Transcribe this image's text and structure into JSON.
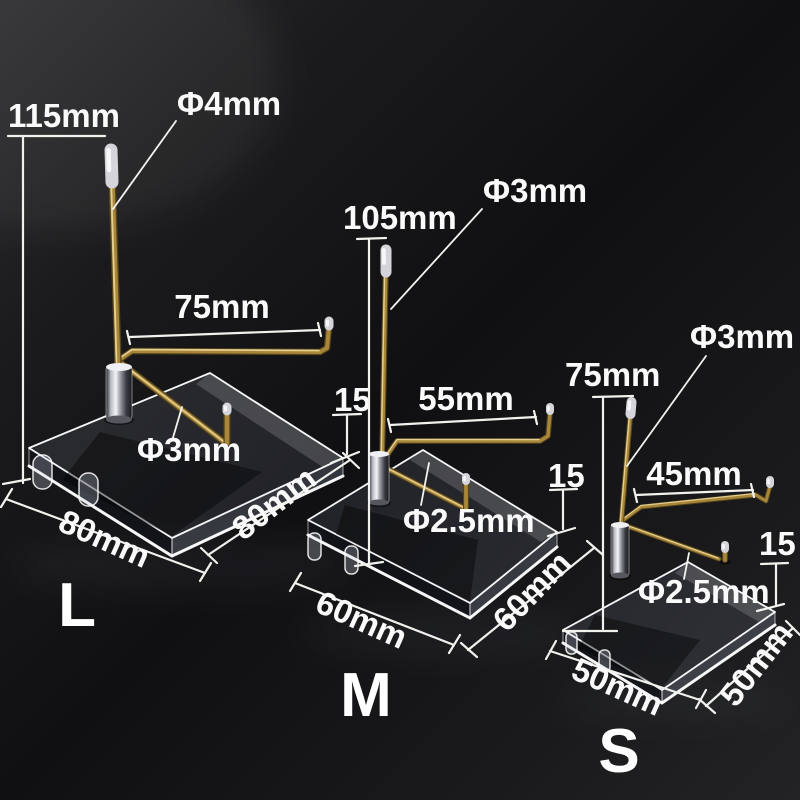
{
  "product": {
    "description_visible_text_only": "",
    "stands": [
      {
        "size_label": "L",
        "height": "115mm",
        "tip_diameter": "Φ4mm",
        "arm_length": "75mm",
        "rod_diameter": "Φ3mm",
        "base_thickness": "15",
        "base_width": "80mm",
        "base_depth": "80mm"
      },
      {
        "size_label": "M",
        "height": "105mm",
        "tip_diameter": "Φ3mm",
        "arm_length": "55mm",
        "rod_diameter": "Φ2.5mm",
        "base_thickness": "15",
        "base_width": "60mm",
        "base_depth": "60mm"
      },
      {
        "size_label": "S",
        "height": "75mm",
        "tip_diameter": "Φ3mm",
        "arm_length": "45mm",
        "rod_diameter": "Φ2.5mm",
        "base_thickness": "15",
        "base_width": "50mm",
        "base_depth": "50mm"
      }
    ],
    "colors": {
      "background_dark": "#121214",
      "background_edge": "#2c2c2e",
      "brass_wire": "#a8873a",
      "brass_highlight": "#ecd89b",
      "chrome_tip": "#d4d4da",
      "acrylic_edge": "#f5f6f8",
      "dimension_lines": "#f1f1ee",
      "label_text": "#fafafa"
    }
  }
}
